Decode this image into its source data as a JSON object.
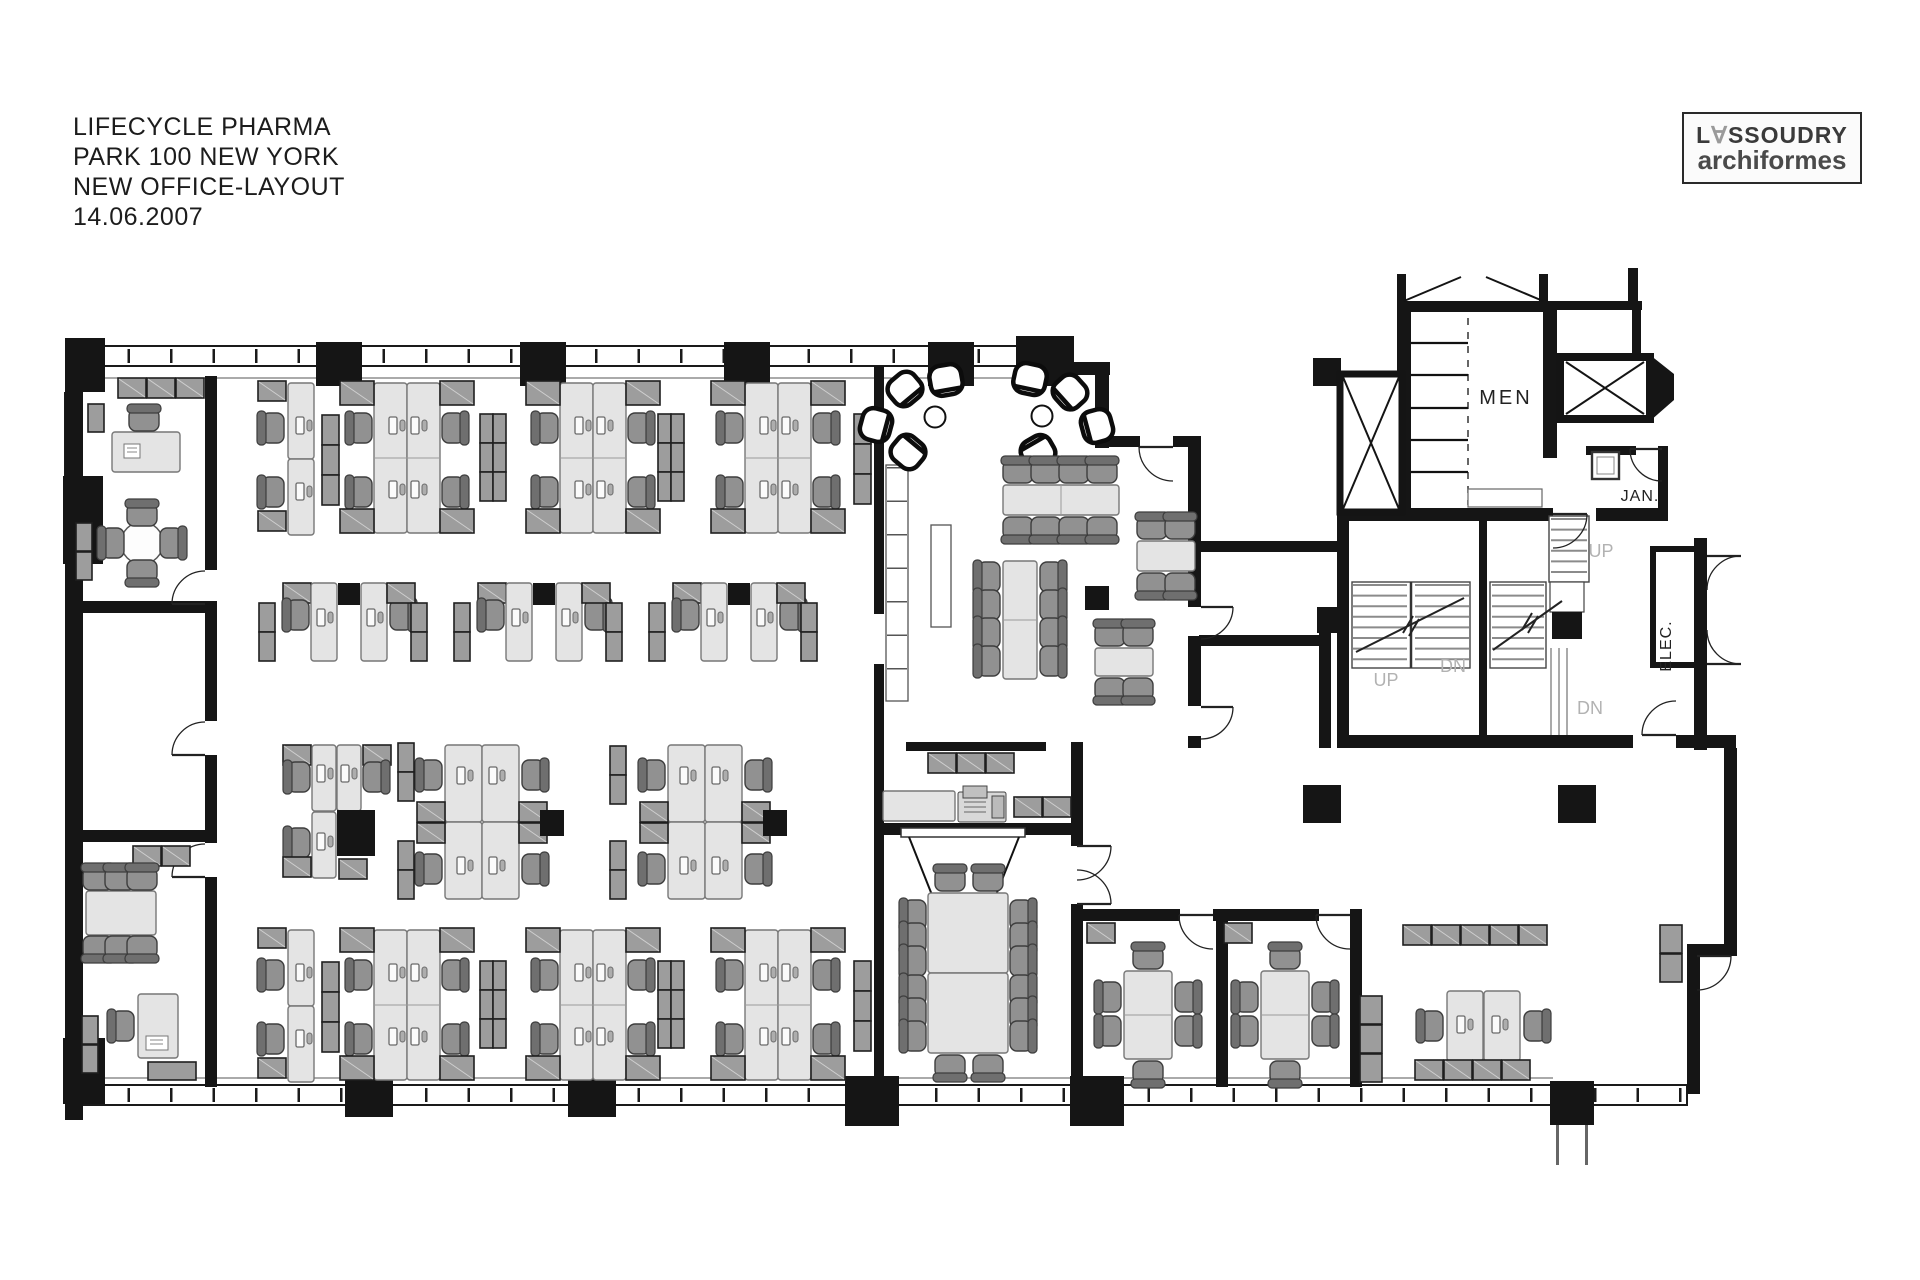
{
  "title_block": {
    "line1": "LIFECYCLE PHARMA",
    "line2": "PARK 100 NEW YORK",
    "line3": "NEW OFFICE-LAYOUT",
    "line4": "14.06.2007"
  },
  "logo": {
    "name_prefix": "L",
    "name_a": "∀",
    "name_suffix": "SSOUDRY",
    "subtitle": "archiformes"
  },
  "plan": {
    "labels": {
      "mens_room": "MEN",
      "janitor": "JAN.",
      "electrical": "ELEC.",
      "stair_up_right": "UP",
      "stair_up_left": "UP",
      "stair_down_left": "DN",
      "stair_down_right": "DN"
    },
    "colors": {
      "wall": "#151515",
      "desk": "#e4e4e4",
      "cabinet": "#9d9d9d",
      "chair": "#919191",
      "label-gray": "#b2b2b2",
      "label-dark": "#222222"
    }
  }
}
